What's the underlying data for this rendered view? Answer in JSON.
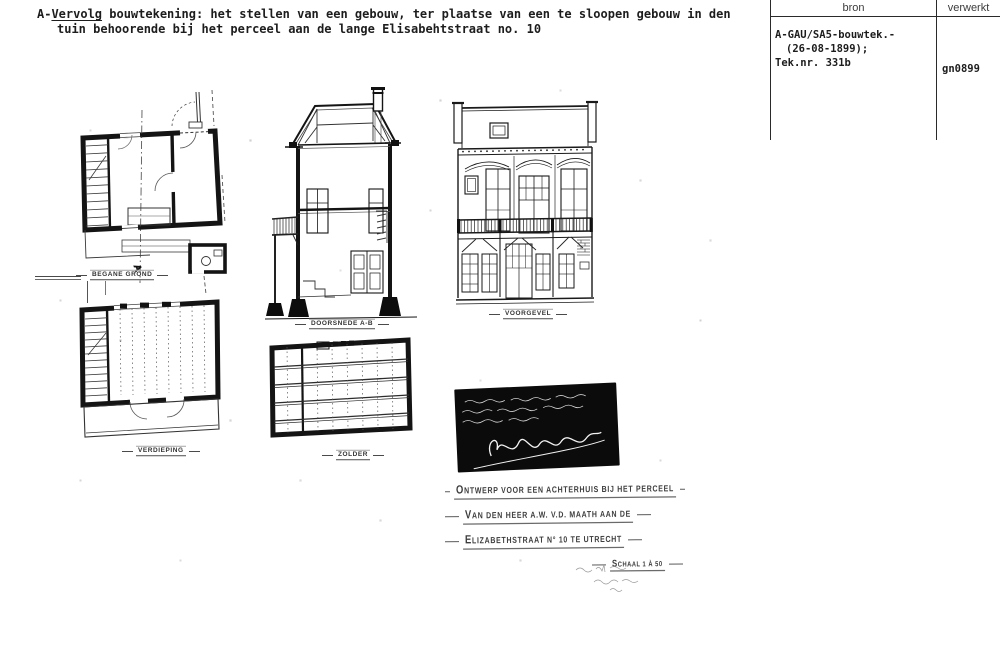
{
  "header": {
    "prefix": "A-",
    "underlined_word": "Vervolg",
    "line1_rest": " bouwtekening: het stellen van een gebouw, ter plaatse van een te sloopen gebouw in den",
    "line2": "tuin behoorende bij het perceel aan de lange Elisabehtstraat no. 10"
  },
  "archive_table": {
    "columns": [
      "bron",
      "verwerkt"
    ],
    "bron_lines": [
      "A-GAU/SA5-bouwtek.-",
      "(26-08-1899);",
      "Tek.nr. 331b"
    ],
    "verwerkt": "gn0899"
  },
  "drawing_labels": {
    "ground_floor": "BEGANE GROND",
    "first_floor": "VERDIEPING",
    "section": "DOORSNEDE A-B",
    "attic": "ZOLDER",
    "facade": "VOORGEVEL",
    "section_marker": "A"
  },
  "title_block": {
    "line1": "ONTWERP VOOR EEN ACHTERHUIS BIJ HET PERCEEL",
    "line2": "VAN DEN HEER A.W. V.D. MAATH AAN DE",
    "line3": "ELIZABETHSTRAAT N° 10 TE UTRECHT",
    "scale": "SCHAAL 1 À 50"
  }
}
